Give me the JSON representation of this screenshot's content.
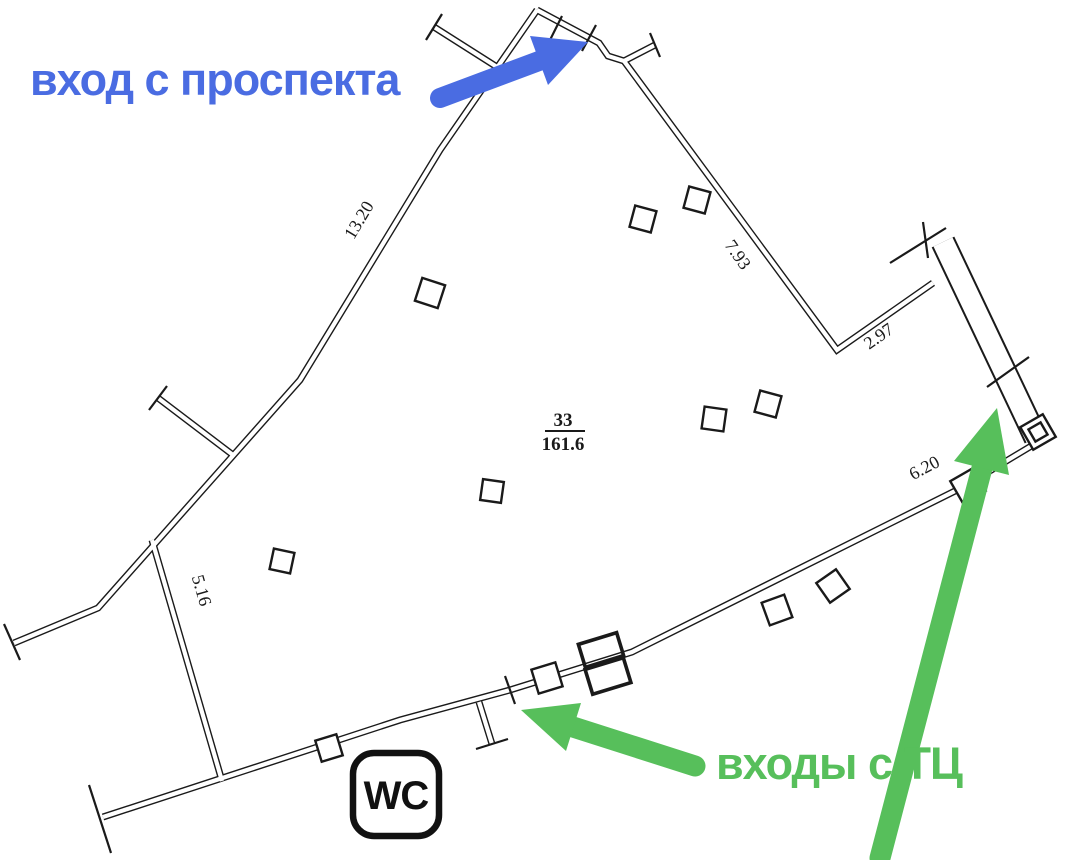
{
  "annotations": {
    "avenue_entrance": "вход с проспекта",
    "mall_entrances": "входы с ТЦ"
  },
  "room": {
    "number": "33",
    "area": "161.6"
  },
  "dimensions": {
    "wall_13_20": "13.20",
    "wall_7_93": "7.93",
    "wall_2_97": "2.97",
    "wall_6_20": "6.20",
    "wall_5_16": "5.16"
  },
  "wc_label": "WC",
  "colors": {
    "annotation_blue": "#4a6ce2",
    "annotation_green": "#57bf5b",
    "drawing_ink": "#1a1a1a",
    "background": "#ffffff"
  }
}
